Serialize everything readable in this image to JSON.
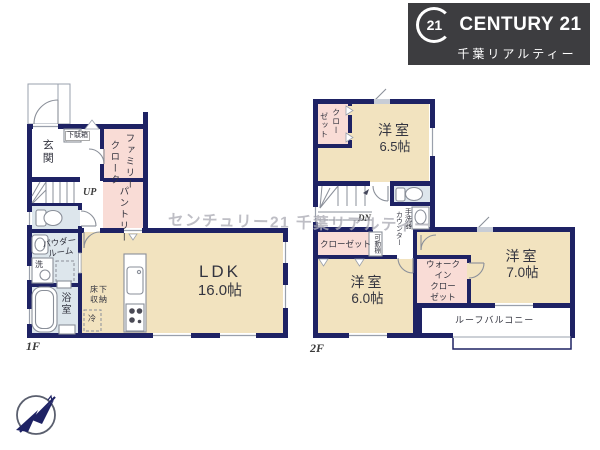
{
  "header": {
    "logo": {
      "seal": "21",
      "brand": "CENTURY 21",
      "company": "千葉リアルティー"
    }
  },
  "watermark": {
    "text": "センチュリー21 千葉リアルティー"
  },
  "floor1": {
    "floor_label": "1F",
    "entrance": "玄関",
    "shoe_box": "下駄箱",
    "family_cloak_col1": "ファミリー",
    "family_cloak_col2": "クローク",
    "pantry": "パントリー",
    "stairs_up": "UP",
    "powder_room_line1": "パウダー",
    "powder_room_line2": "ルーム",
    "washer": "洗",
    "bathroom": "浴室",
    "ldk_name": "LDK",
    "ldk_size": "16.0帖",
    "underfloor_line1": "床下",
    "underfloor_line2": "収納",
    "fridge": "冷"
  },
  "floor2": {
    "floor_label": "2F",
    "closet_a_col1": "クロー",
    "closet_a_col2": "ゼット",
    "room_65_name": "洋室",
    "room_65_size": "6.5帖",
    "stairs_down": "DN",
    "wash_counter_col1": "手洗器",
    "wash_counter_col2": "カウンター",
    "movable_shelf": "可動棚",
    "closet_b": "クローゼット",
    "room_60_name": "洋室",
    "room_60_size": "6.0帖",
    "wic_line1": "ウォーク",
    "wic_line2": "イン",
    "wic_line3": "クロー",
    "wic_line4": "ゼット",
    "room_70_name": "洋室",
    "room_70_size": "7.0帖",
    "roof_balcony": "ルーフバルコニー"
  },
  "colors": {
    "wall": "#1e2264",
    "cream": "#f2e3bf",
    "pink": "#f9dcd6",
    "blue": "#dde6ec",
    "line": "#8a8f99",
    "logo_bg": "#3d3d40"
  }
}
